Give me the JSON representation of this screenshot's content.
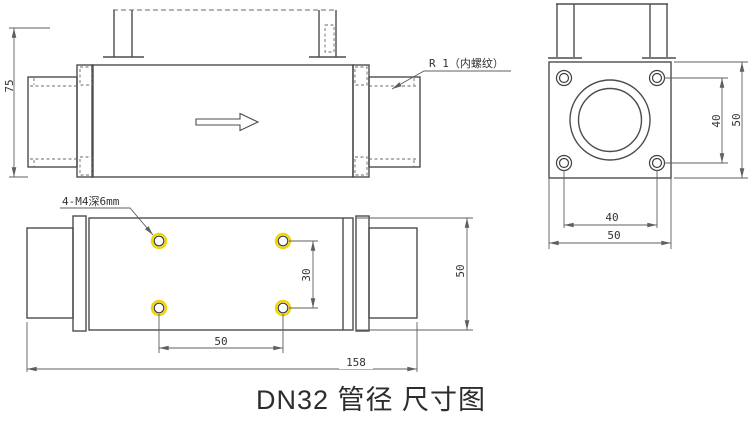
{
  "title": {
    "caption": "DN32 管径 尺寸图"
  },
  "side_view": {
    "height_dim": "75",
    "thread_note": "R 1（内螺纹）"
  },
  "end_view": {
    "hole_pitch_vertical": "40",
    "overall_height": "50",
    "hole_pitch_horizontal": "40",
    "overall_width": "50"
  },
  "plan_view": {
    "tapped_holes_note": "4-M4深6mm",
    "hole_pitch_vertical": "30",
    "hole_pitch_horizontal": "50",
    "overall_length": "158",
    "overall_width": "50"
  },
  "colors": {
    "outline": "#4d4d4d",
    "dimension_lines": "#5f5f5f",
    "text": "#333333",
    "hole_highlight": "#f2d500",
    "background": "#ffffff"
  }
}
